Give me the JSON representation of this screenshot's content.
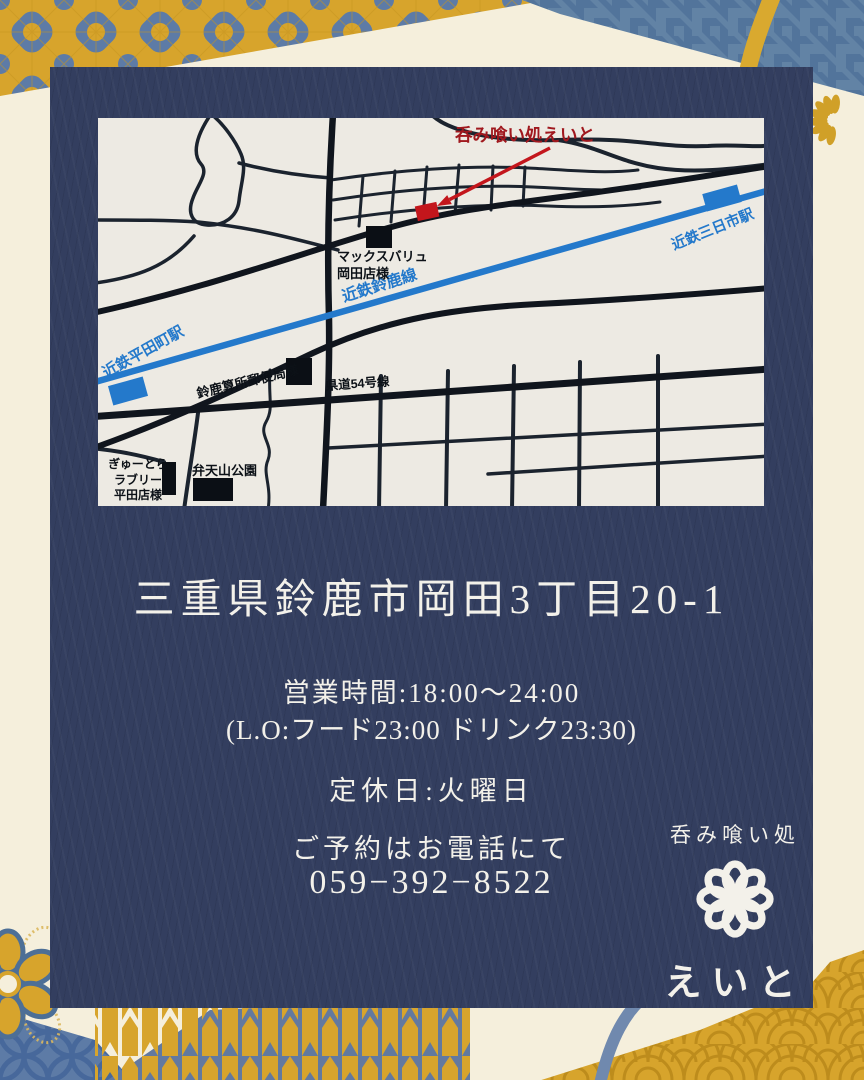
{
  "map": {
    "marker_label": "呑み喰い処えいと",
    "railway": {
      "line_label": "近鉄鈴鹿線",
      "station_left": "近鉄平田町駅",
      "station_right": "近鉄三日市駅"
    },
    "road_label": "県道54号線",
    "landmarks": {
      "maxvalu_line1": "マックスバリュ",
      "maxvalu_line2": "岡田店様",
      "post_office": "鈴鹿算所郵便局様",
      "gyutora_line1": "ぎゅーとら",
      "gyutora_line2": "ラブリー",
      "gyutora_line3": "平田店様",
      "park": "弁天山公園"
    }
  },
  "info": {
    "address": "三重県鈴鹿市岡田3丁目20-1",
    "hours_line1": "営業時間:18:00〜24:00",
    "hours_line2": "(L.O:フード23:00  ドリンク23:30)",
    "closed_day": "定休日:火曜日",
    "reservation": "ご予約はお電話にて",
    "phone": "059−392−8522"
  },
  "logo": {
    "tagline": "呑み喰い処",
    "name": "えいと"
  },
  "colors": {
    "card_navy": "#333e5f",
    "cream": "#f5efdc",
    "map_paper": "#edeae3",
    "gold": "#d7a42c",
    "pattern_blue": "#5d7ba6",
    "railway_blue": "#2479cb",
    "accent_red": "#c3161c",
    "label_red": "#a0181e"
  }
}
